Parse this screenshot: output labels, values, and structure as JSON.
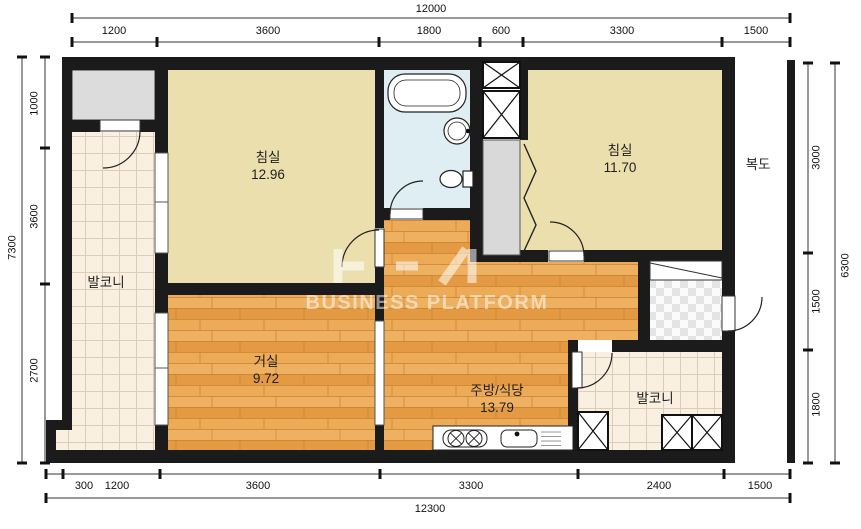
{
  "watermark": {
    "text": "BUSINESS PLATFORM"
  },
  "rooms": {
    "bedroom1": {
      "name": "침실",
      "area": "12.96"
    },
    "bedroom2": {
      "name": "침실",
      "area": "11.70"
    },
    "living": {
      "name": "거실",
      "area": "9.72"
    },
    "kitchen_dining": {
      "name": "주방/식당",
      "area": "13.79"
    },
    "balcony_left": {
      "name": "발코니"
    },
    "balcony_right": {
      "name": "발코니"
    },
    "corridor": {
      "name": "복도"
    }
  },
  "dims": {
    "top": {
      "total": "12000",
      "segments": [
        "1200",
        "3600",
        "1800",
        "600",
        "3300",
        "1500"
      ]
    },
    "bottom": {
      "total": "12300",
      "segments": [
        "300",
        "1200",
        "3600",
        "3300",
        "2400",
        "1500"
      ]
    },
    "left": {
      "total": "7300",
      "segments": [
        "1000",
        "3600",
        "2700"
      ]
    },
    "right": {
      "total": "6300",
      "segments": [
        "3000",
        "1500",
        "1800"
      ]
    }
  },
  "colors": {
    "wall": "#1b1b1b",
    "bedroom_floor": "#ebdfae",
    "bathroom_floor": "#dfeef2",
    "wood_floor": "#e8a24b",
    "tile_floor": "#faf0e2",
    "storage_gray": "#dcdcdc"
  }
}
